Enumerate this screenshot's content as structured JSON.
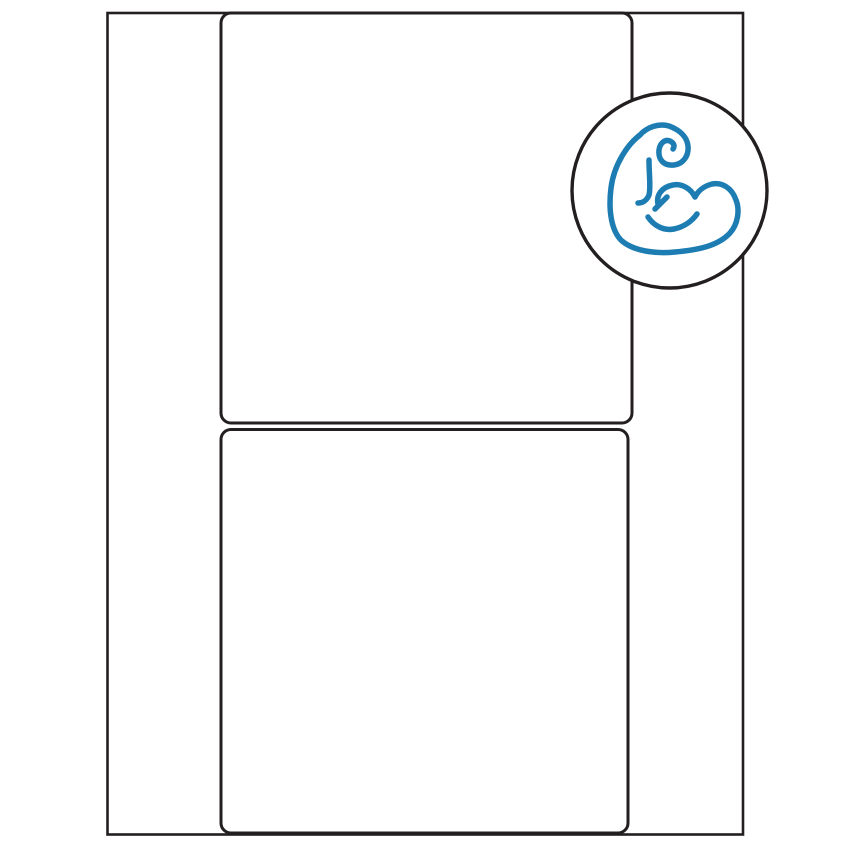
{
  "page": {
    "background": "#ffffff"
  },
  "colors": {
    "line": "#231f20",
    "icon_blue": "#1d7db3",
    "surface": "#ffffff"
  },
  "diagram": {
    "sheet": {
      "label_slot_count": 2
    },
    "badge": {
      "shape": "circle",
      "icon": "flexed-biceps-icon",
      "icon_color": "#1d7db3"
    }
  }
}
